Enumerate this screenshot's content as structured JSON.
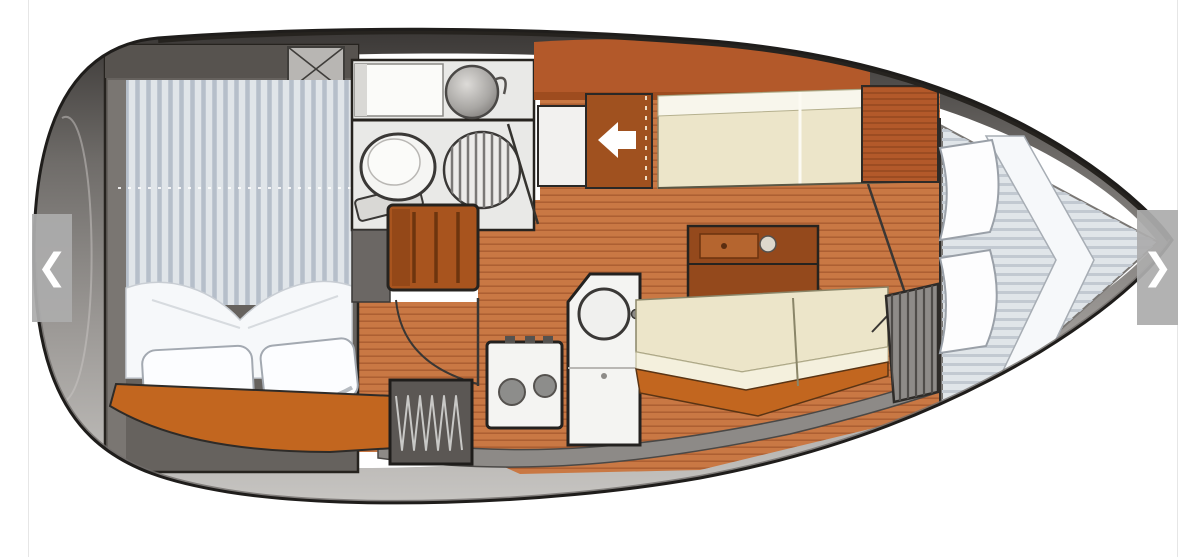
{
  "figure": {
    "alt": "Top-view interior layout plan of a sailboat: aft double cabin, head with toilet and shower, companionway steps, galley with stove and sink, saloon with table and two settees, and a forward V-berth cabin."
  },
  "carousel": {
    "prev_icon": "❮",
    "next_icon": "❯"
  },
  "icons": {
    "prev": "chevron-left-icon",
    "next": "chevron-right-icon",
    "companionway_arrow": "arrow-left-icon",
    "deck_hatch": "x-cross-icon"
  },
  "palette": {
    "page_bg": "#ffffff",
    "hull_outline": "#1f1d1b",
    "hull_gray": "#8d8a87",
    "deck_white": "#ffffff",
    "cabin_wall_gray": "#66625e",
    "cabin_wall_dark": "#57534f",
    "mattress_blue_gray": "#e0e5e9",
    "mattress_stripe": "#b6bfca",
    "bedding_white": "#f6f8fa",
    "wood_floor": "#c97844",
    "shelf_orange": "#c2661f",
    "steps_brown": "#a8541e",
    "cabinet_orange": "#b3592a",
    "arrow_panel_brown": "#a0511f",
    "table_brown": "#94491c",
    "settee_cream": "#ece5c9",
    "fixture_white": "#f4f4f2",
    "counter_gray": "#8d8a87",
    "locker_gray": "#5b5754",
    "nav_button_gray": "#acacac",
    "nav_chevron_white": "#ffffff"
  }
}
